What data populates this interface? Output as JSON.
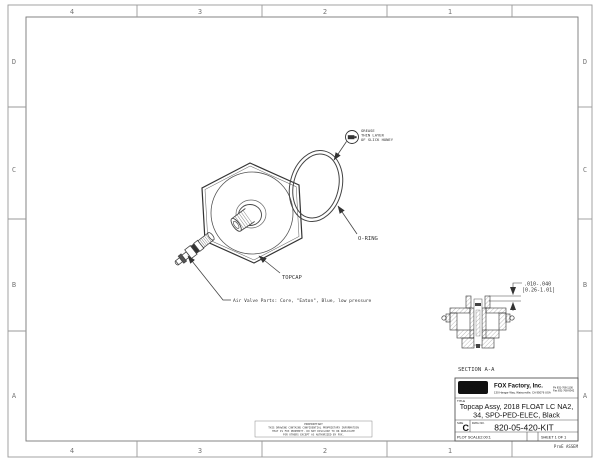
{
  "sheet": {
    "zones_top": [
      "4",
      "3",
      "2",
      "1"
    ],
    "zones_bottom": [
      "4",
      "3",
      "2",
      "1"
    ],
    "zones_left": [
      "D",
      "C",
      "B",
      "A"
    ],
    "zones_right": [
      "D",
      "C",
      "B",
      "A"
    ]
  },
  "callouts": {
    "grease_line1": "GREASE",
    "grease_line2": "THIN LAYER",
    "grease_line3": "OF SLICK HONEY",
    "oring_label": "O-RING",
    "topcap_label": "TOPCAP",
    "air_valve_note": "Air Valve Parts: Core, \"Eaton\", Blue, low pressure"
  },
  "section": {
    "label": "SECTION A-A",
    "dim_line1": ".010-.040",
    "dim_line2": "[0.26-1.01]"
  },
  "proprietary": {
    "line1": "PROPRIETARY",
    "line2": "THIS DRAWING CONTAINS CONFIDENTIAL PROPRIETARY INFORMATION",
    "line3": "THAT IS FOX PROPERTY. DO NOT DISCLOSE TO OR DUPLICATE",
    "line4": "FOR OTHERS EXCEPT AS AUTHORIZED BY FOX."
  },
  "title_block": {
    "logo_text": "FOX",
    "company": "FOX Factory, Inc.",
    "address": "130 Hangar Way, Watsonville, CA 95076 USA",
    "phone": "Ph 831-768-1100",
    "fax": "Fax 831-768-9342",
    "title_label": "TITLE",
    "title_line1": "Topcap Assy, 2018 FLOAT LC NA2,",
    "title_line2": "34, SPD-PED-ELEC, Black",
    "size_label": "SIZE",
    "size": "C",
    "dwg_label": "DWG NO.",
    "dwg_no": "820-05-420-KIT",
    "plot_scale": "PLOT SCALE2.00:1",
    "sheet_of": "SHEET 1 OF 1",
    "footer": "ProE ASSEM"
  },
  "colors": {
    "line": "#444",
    "border": "#888",
    "ink": "#333"
  }
}
